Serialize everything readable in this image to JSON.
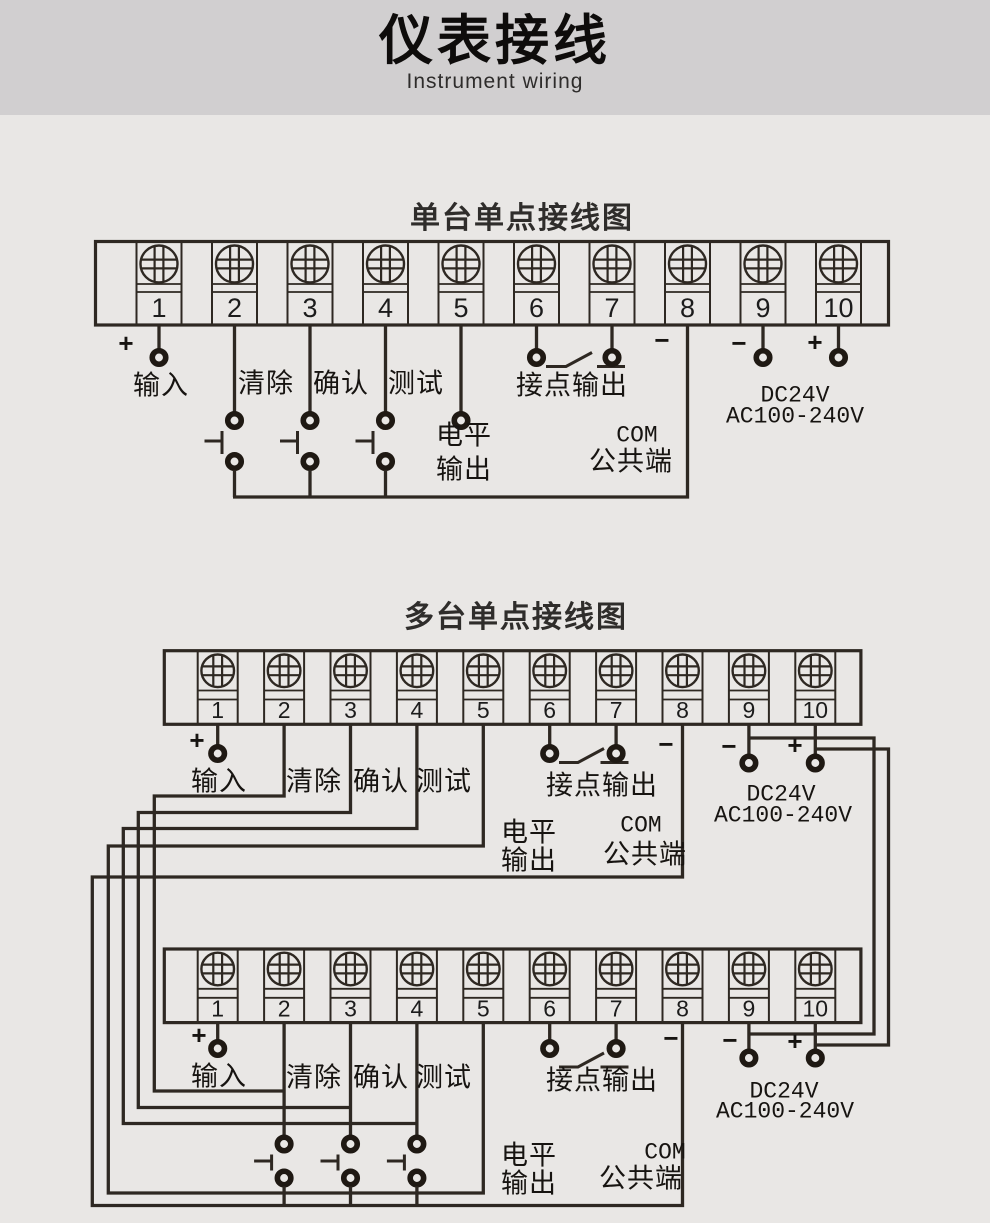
{
  "page": {
    "title": "仪表接线",
    "subtitle": "Instrument wiring"
  },
  "sections": [
    {
      "title": "单台单点接线图"
    },
    {
      "title": "多台单点接线图"
    }
  ],
  "terminal_numbers": [
    "1",
    "2",
    "3",
    "4",
    "5",
    "6",
    "7",
    "8",
    "9",
    "10"
  ],
  "labels": {
    "input": "输入",
    "clear": "清除",
    "confirm": "确认",
    "test": "测试",
    "contact_output": "接点输出",
    "level_line1": "电平",
    "level_line2": "输出",
    "com": "COM",
    "common": "公共端",
    "dc": "DC24V",
    "ac": "AC100-240V",
    "plus": "+",
    "minus": "−"
  },
  "colors": {
    "line": "#2e2822",
    "ring": "#1f1913",
    "text": "#1c1c1c",
    "bg": "#e9e7e5",
    "header_bg": "#d1cfd0"
  }
}
